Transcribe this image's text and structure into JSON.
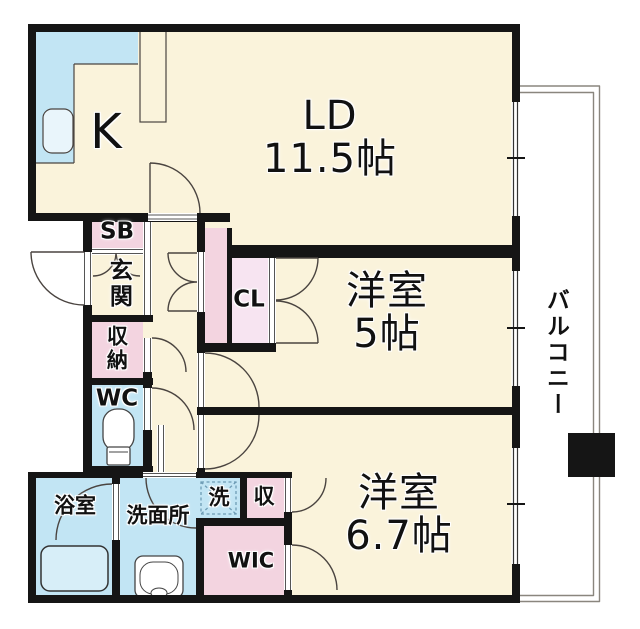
{
  "floorplan": {
    "kitchen": {
      "label": "K"
    },
    "living_dining": {
      "label": "LD",
      "size": "11.5帖"
    },
    "bedroom_5": {
      "label": "洋室",
      "size": "5帖"
    },
    "bedroom_6_7": {
      "label": "洋室",
      "size": "6.7帖"
    },
    "balcony": {
      "label": "バルコニー"
    },
    "shoe_box": {
      "label": "SB"
    },
    "entrance": {
      "label": "玄関"
    },
    "hall_storage": {
      "label": "収納"
    },
    "toilet": {
      "label": "WC"
    },
    "closet": {
      "label": "CL"
    },
    "bathroom": {
      "label": "浴室"
    },
    "washroom": {
      "label": "洗面所"
    },
    "washer_space": {
      "label": "洗"
    },
    "storage_small": {
      "label": "収"
    },
    "walk_in_closet": {
      "label": "WIC"
    }
  },
  "colors": {
    "floor": "#FAF3DB",
    "water_blue": "#C2E5F4",
    "storage_pink": "#F3D4E0",
    "closet_pink": "#F7E4F1",
    "wall": "#151515"
  }
}
